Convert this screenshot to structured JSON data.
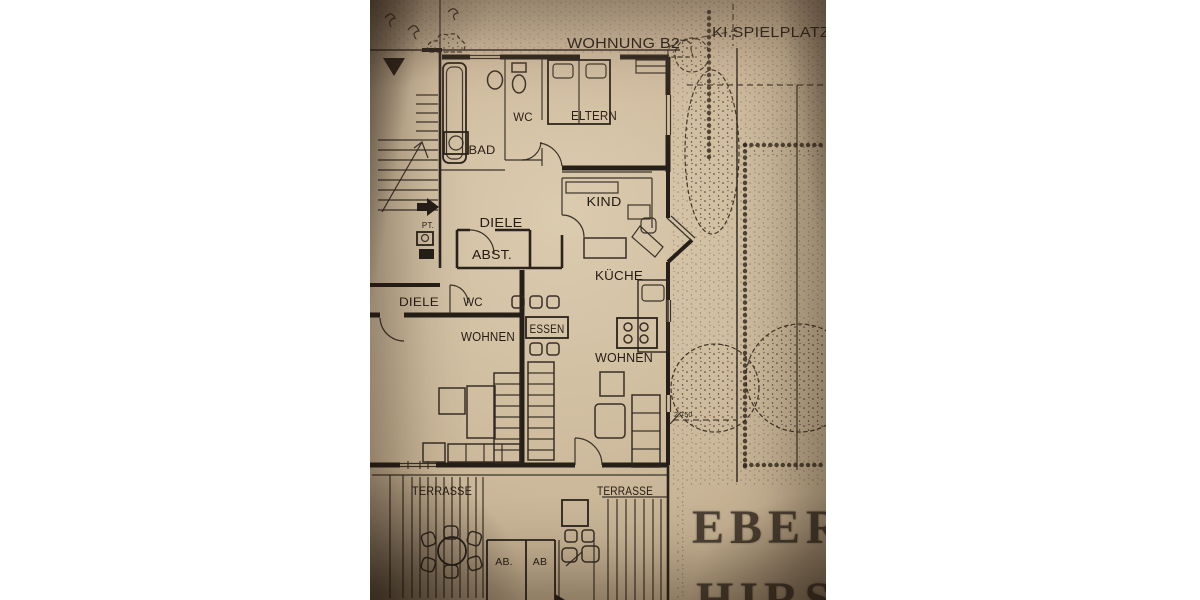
{
  "photo": {
    "header": {
      "apartment_title": "WOHNUNG B2",
      "playground_label": "KI.SPIELPLATZ"
    },
    "rooms": {
      "bad": "BAD",
      "wc_upper": "WC",
      "eltern": "ELTERN",
      "pt": "PT.",
      "diele_upper": "DIELE",
      "abst": "ABST.",
      "kind": "KIND",
      "kueche": "KÜCHE",
      "diele_lower": "DIELE",
      "wc_lower": "WC",
      "wohnen_left": "WOHNEN",
      "essen": "ESSEN",
      "wohnen_right": "WOHNEN",
      "terrasse_left": "TERRASSE",
      "terrasse_right": "TERRASSE",
      "ab_left": "AB.",
      "ab_right": "AB"
    },
    "annotations": {
      "dimension": "2.750"
    },
    "stencil": {
      "line1": "EBER",
      "line2": "HIRSC"
    },
    "colors": {
      "paper": "#cfbc9e",
      "ink": "#261f18",
      "stencil_ink": "#42382c",
      "margin": "#ffffff"
    }
  }
}
